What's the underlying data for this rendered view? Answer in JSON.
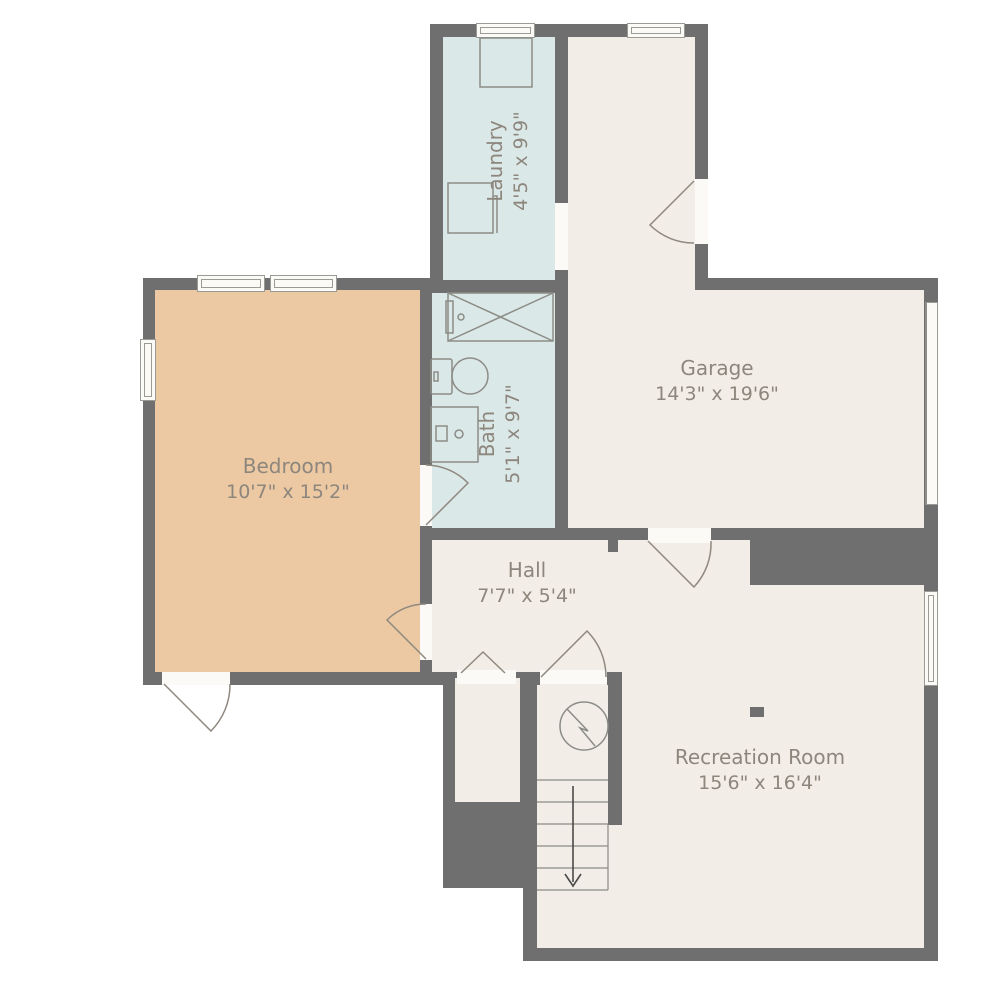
{
  "plan": {
    "title": "Basement floor plan",
    "rooms": {
      "bedroom": {
        "name": "Bedroom",
        "dims": "10'7\" x 15'2\""
      },
      "garage": {
        "name": "Garage",
        "dims": "14'3\" x 19'6\""
      },
      "laundry": {
        "name": "Laundry",
        "dims": "4'5\" x 9'9\""
      },
      "bath": {
        "name": "Bath",
        "dims": "5'1\" x 9'7\""
      },
      "hall": {
        "name": "Hall",
        "dims": "7'7\" x 5'4\""
      },
      "recreation": {
        "name": "Recreation Room",
        "dims": "15'6\" x 16'4\""
      }
    },
    "fixtures": [
      "washer",
      "laundry-counter",
      "shower",
      "toilet",
      "sink-vanity",
      "water-heater",
      "stairs-down-arrow",
      "support-post"
    ],
    "stairs": {
      "direction": "down"
    },
    "colors": {
      "wall": "#6f6f6f",
      "floor_cream": "#f2ede7",
      "floor_peach": "#edc9a3",
      "floor_blue": "#dbe8e8",
      "opening_white": "#fbfaf7",
      "label_text": "#8d867d"
    }
  }
}
